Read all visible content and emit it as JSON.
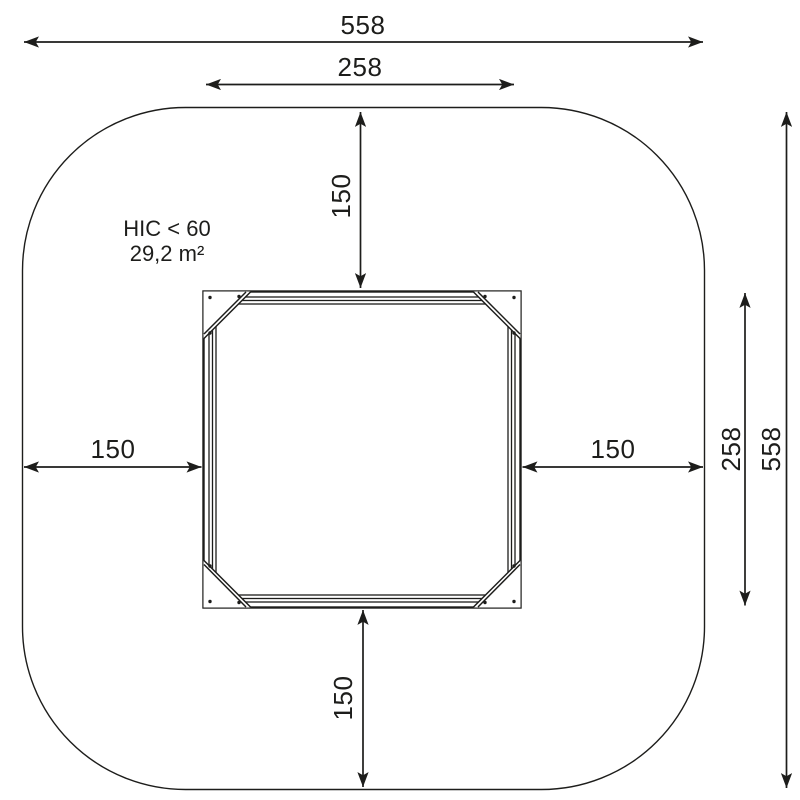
{
  "drawing": {
    "annotations": {
      "hic": "HIC < 60",
      "area": "29,2 m²"
    },
    "dimensions": {
      "outer_width": "558",
      "outer_height": "558",
      "inner_width": "258",
      "inner_height": "258",
      "clearance_top": "150",
      "clearance_bottom": "150",
      "clearance_left": "150",
      "clearance_right": "150"
    },
    "colors": {
      "line": "#1d1d1b",
      "background": "#ffffff"
    }
  }
}
